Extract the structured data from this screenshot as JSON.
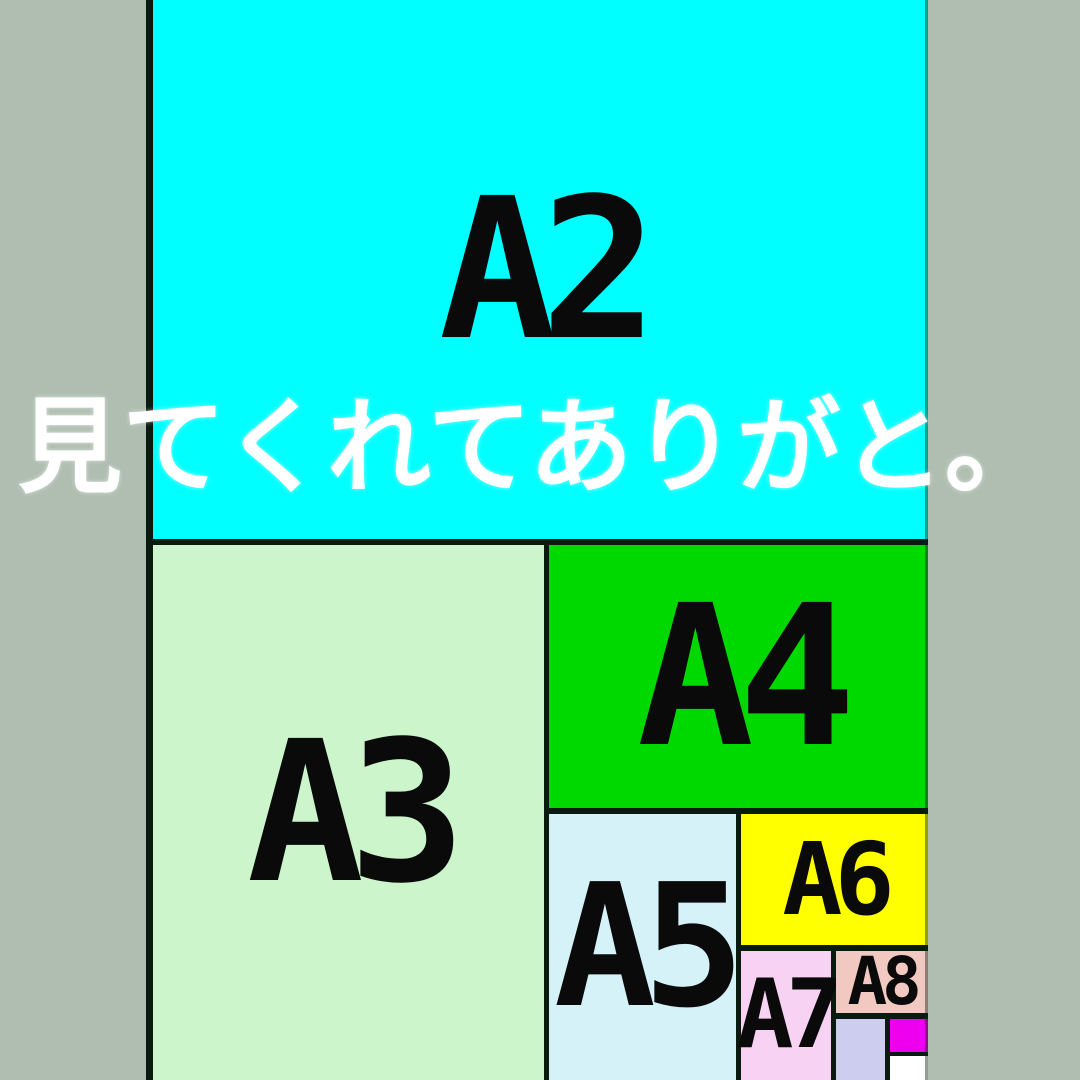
{
  "caption": {
    "text": "見てくれてありがと。",
    "color": "#ffffff"
  },
  "diagram": {
    "description": "A-series paper size comparison diagram, cropped at top, right and bottom",
    "background_color": "#afbeb1",
    "border_color": "#0a1a0f",
    "label_color": "#0a0a0a",
    "regions": [
      {
        "id": "a2",
        "label": "A2",
        "color": "#00ffff"
      },
      {
        "id": "a3",
        "label": "A3",
        "color": "#ccf5cc"
      },
      {
        "id": "a4",
        "label": "A4",
        "color": "#00d900"
      },
      {
        "id": "a5",
        "label": "A5",
        "color": "#d4f2f7"
      },
      {
        "id": "a6",
        "label": "A6",
        "color": "#ffff00"
      },
      {
        "id": "a7",
        "label": "A7",
        "color": "#f8d2f2"
      },
      {
        "id": "a8",
        "label": "A8",
        "color": "#f2c9c0"
      },
      {
        "id": "a9",
        "label": "",
        "color": "#cdcdf0"
      },
      {
        "id": "a10",
        "label": "",
        "color": "#ee00ee"
      },
      {
        "id": "a11",
        "label": "",
        "color": "#ffffff"
      }
    ]
  }
}
